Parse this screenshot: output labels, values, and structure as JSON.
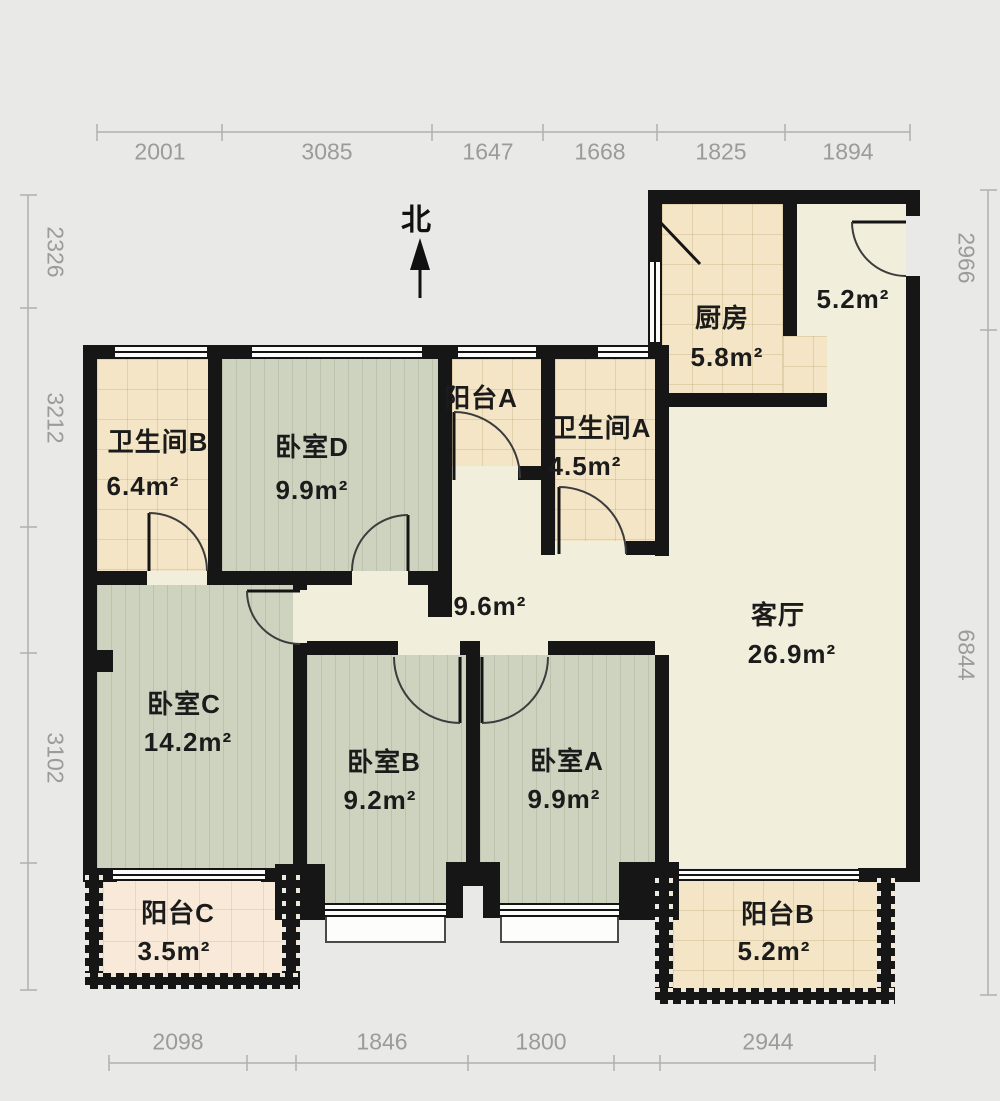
{
  "north_label": "北",
  "dimensions": {
    "top": [
      "2001",
      "3085",
      "1647",
      "1668",
      "1825",
      "1894"
    ],
    "bottom": [
      "2098",
      "1846",
      "1800",
      "2944"
    ],
    "left": [
      "2326",
      "3212",
      "3102"
    ],
    "right": [
      "2966",
      "6844"
    ]
  },
  "rooms": {
    "bathroom_b": {
      "name": "卫生间B",
      "area": "6.4m²"
    },
    "bedroom_d": {
      "name": "卧室D",
      "area": "9.9m²"
    },
    "balcony_a": {
      "name": "阳台A"
    },
    "bathroom_a": {
      "name": "卫生间A",
      "area": "4.5m²"
    },
    "kitchen": {
      "name": "厨房",
      "area": "5.8m²"
    },
    "entry": {
      "area": "5.2m²"
    },
    "hallway": {
      "area": "9.6m²"
    },
    "living_room": {
      "name": "客厅",
      "area": "26.9m²"
    },
    "bedroom_c": {
      "name": "卧室C",
      "area": "14.2m²"
    },
    "bedroom_b": {
      "name": "卧室B",
      "area": "9.2m²"
    },
    "bedroom_a": {
      "name": "卧室A",
      "area": "9.9m²"
    },
    "balcony_c": {
      "name": "阳台C",
      "area": "3.5m²"
    },
    "balcony_b": {
      "name": "阳台B",
      "area": "5.2m²"
    }
  },
  "palette": {
    "background": "#e9e9e7",
    "wall": "#161616",
    "tile_floor": "#f3e5c5",
    "balcony_c_floor": "#f8e9d8",
    "plank_floor": "#ced3bf",
    "cream_floor": "#f2eedc",
    "dimension_text": "#9b9b9b",
    "label_text": "#1b1b1b"
  }
}
